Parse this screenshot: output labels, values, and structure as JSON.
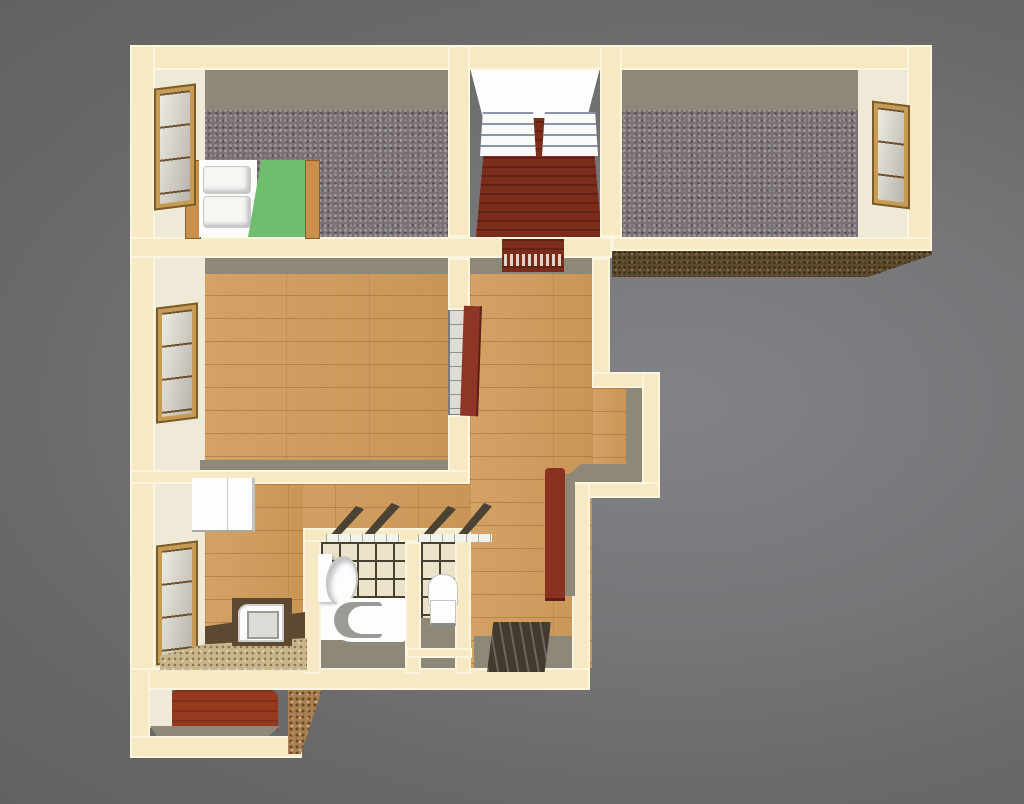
{
  "scene": {
    "description": "3D top-down architectural render of an apartment floor plan on a plain gray background, cream colored walls, no text labels",
    "rooms": [
      {
        "id": "bedroom-left",
        "floor": "gray-speckled-carpet",
        "furniture": [
          "double-bed-white-green"
        ],
        "windows": 1
      },
      {
        "id": "walk-in-closet",
        "floor": "dark-red-carpet",
        "furniture": [
          "wire-shelving-unit",
          "wire-shelving-unit"
        ]
      },
      {
        "id": "bedroom-right",
        "floor": "gray-speckled-carpet",
        "windows": 1
      },
      {
        "id": "living-room",
        "floor": "wood-planks",
        "windows": 1,
        "doors": [
          "red-door-open",
          "glazed-panel"
        ]
      },
      {
        "id": "hallway",
        "floor": "wood-planks",
        "features": [
          "alcove-right",
          "doorway-to-closet-with-striped-threshold"
        ]
      },
      {
        "id": "kitchen",
        "floor": "wood-planks",
        "furniture": [
          "refrigerator",
          "stove",
          "granite-counter"
        ],
        "windows": 1
      },
      {
        "id": "bathroom",
        "floor": "tile-grid",
        "fixtures": [
          "vanity-sink",
          "bathtub"
        ],
        "features": [
          "tilted-transom-windows"
        ]
      },
      {
        "id": "wc",
        "floor": "tile-grid",
        "fixtures": [
          "toilet"
        ],
        "features": [
          "tilted-transom-windows"
        ]
      },
      {
        "id": "entry",
        "floor": "wood-planks",
        "furniture": [
          "red-wardrobe",
          "striped-doormat"
        ]
      },
      {
        "id": "balcony",
        "floor": "rust-red"
      }
    ]
  },
  "palette": {
    "bg_center": "#828387",
    "bg_edge": "#616161",
    "wall_fill": "#F6E9C4",
    "wall_edge": "#FBF5DE",
    "face_gray": "#8E8878",
    "face_light": "#EFE9D7",
    "wing_band": "#5C4B2D",
    "carpet": "#7A7076",
    "wood": "#D19C5B",
    "closet_floor": "#7B2C1B",
    "balcony_floor": "#95391F",
    "door_red": "#8E3526",
    "wardrobe_red": "#8A3122",
    "tile": "#EBE2CA",
    "tile_line": "#46412F",
    "white": "#FDFDFD",
    "fixture_shadow": "#9A9A96",
    "mat_dark": "#433B31",
    "granite": "#C9B58C",
    "counter_brown": "#5D4831",
    "blanket_green": "#6FBE6E",
    "bed_frame": "#C98F4C",
    "window_frame": "#C89B55",
    "shelf_white": "#FAFAF8",
    "closet_back": "#FDFDFB",
    "brick": "#A87F4F"
  }
}
